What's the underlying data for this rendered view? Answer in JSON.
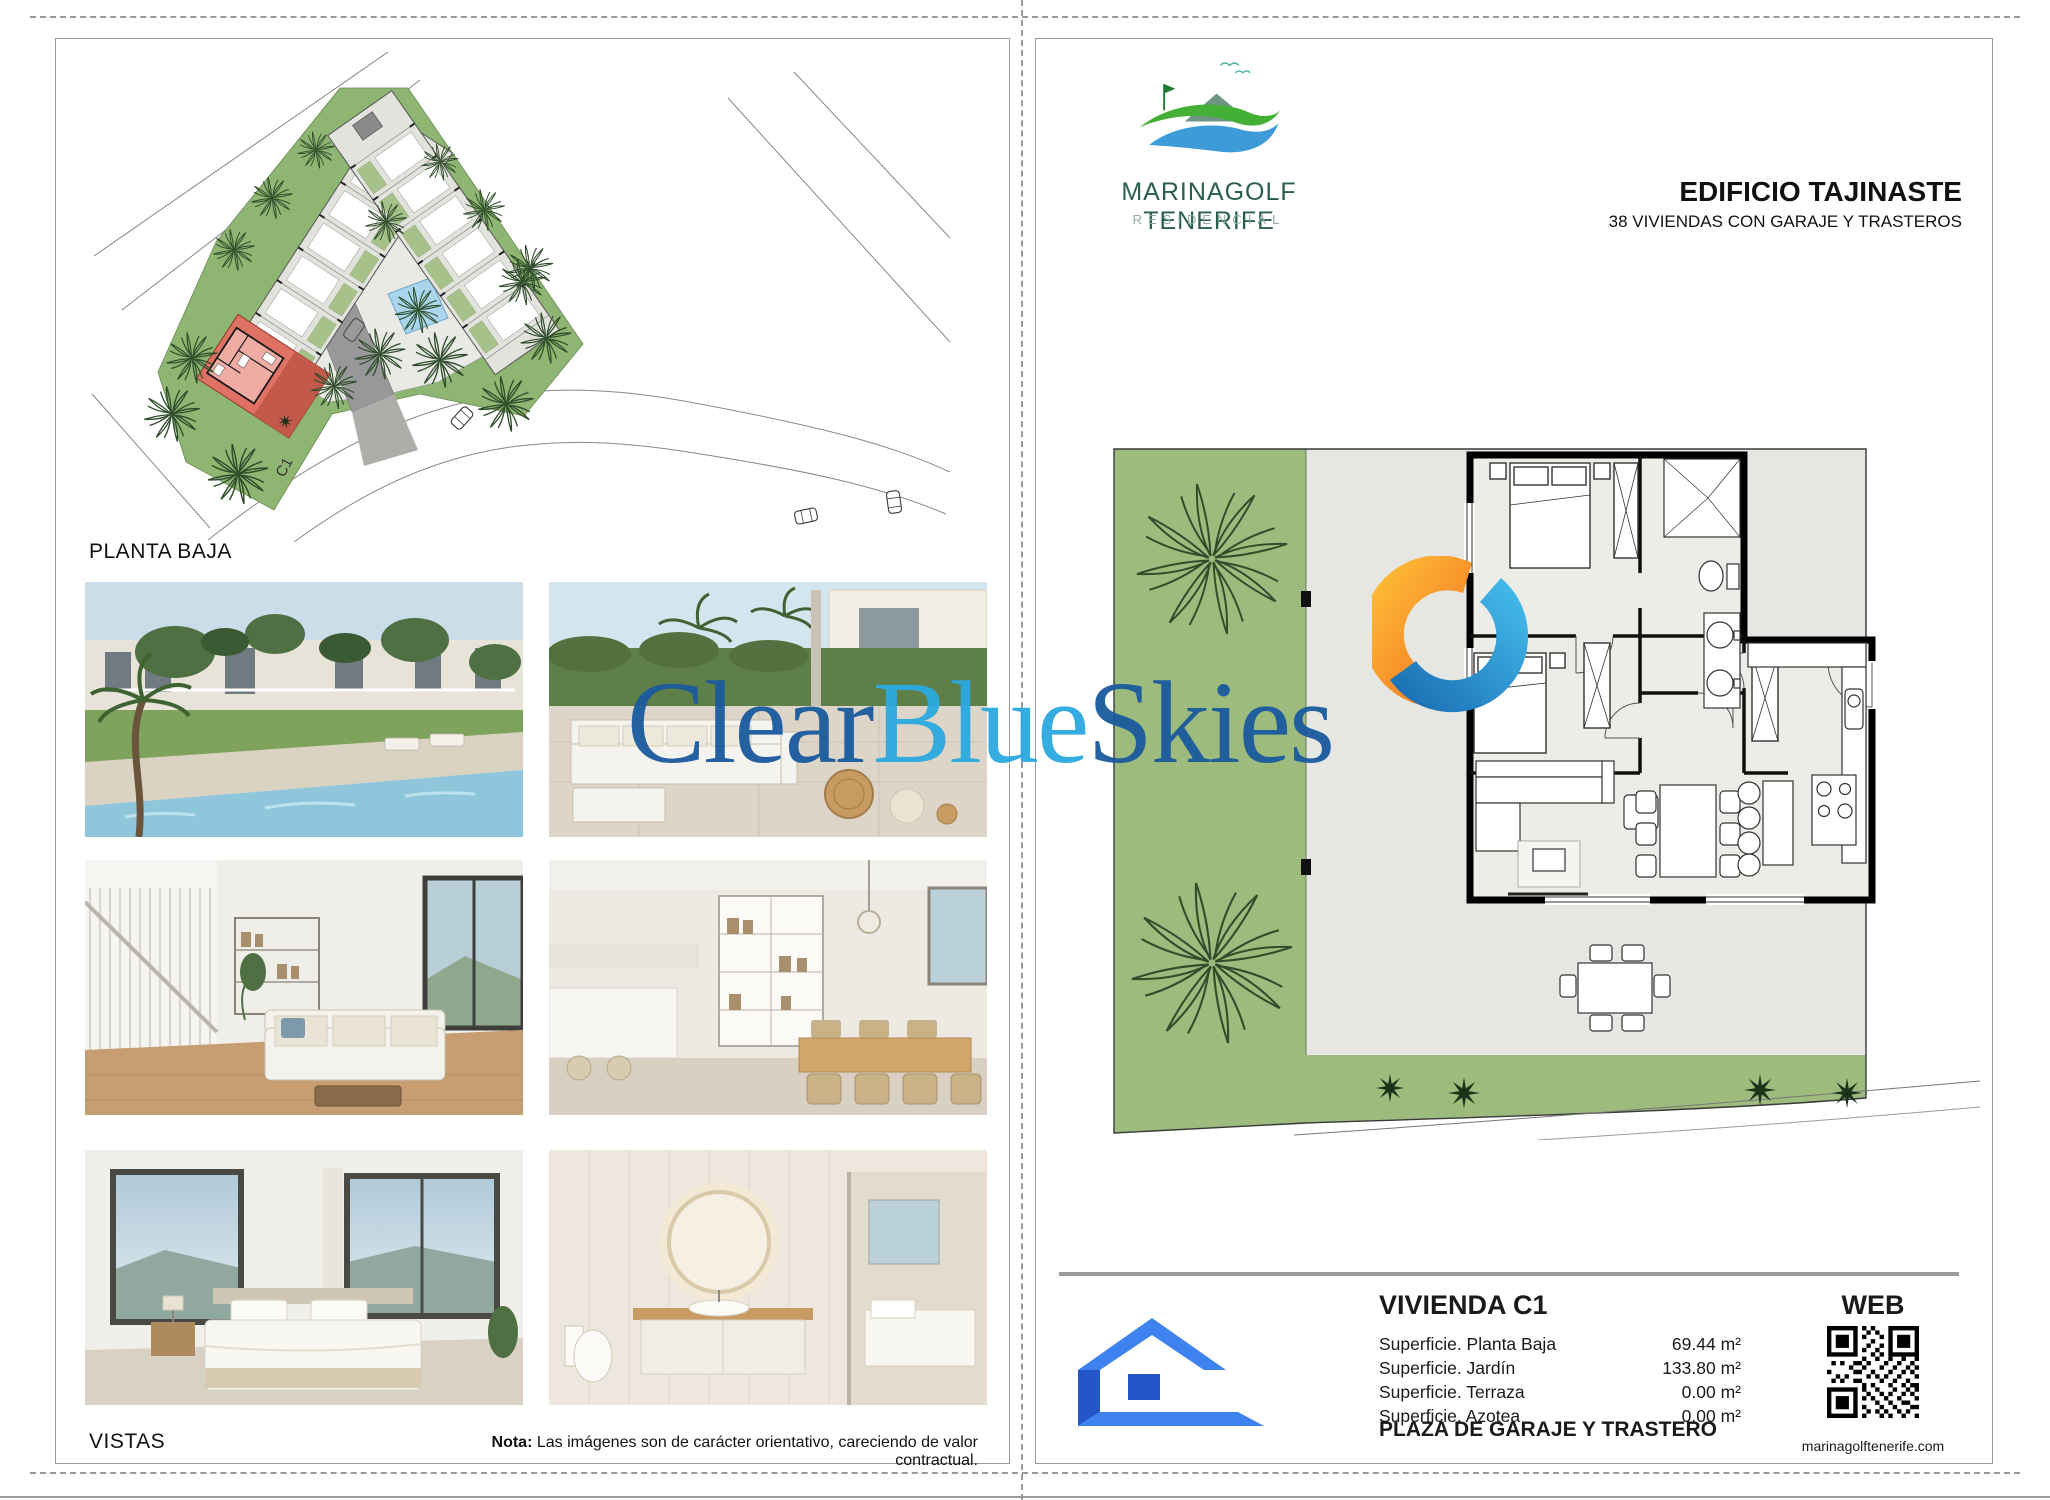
{
  "brand": {
    "name": "MARINAGOLF TENERIFE",
    "tagline": "RESIDENCIAL"
  },
  "header": {
    "title": "EDIFICIO TAJINASTE",
    "subtitle": "38 VIVIENDAS CON GARAJE Y TRASTEROS"
  },
  "left_page": {
    "plan_label": "PLANTA BAJA",
    "unit_marker": "C1",
    "photos_label": "VISTAS",
    "note": {
      "bold": "Nota:",
      "text": " Las imágenes son de carácter orientativo, careciendo de valor contractual."
    }
  },
  "unit_card": {
    "title": "VIVIENDA C1",
    "surfaces": [
      {
        "label": "Superficie. Planta Baja",
        "value": "69.44",
        "unit": "m²"
      },
      {
        "label": "Superficie. Jardín",
        "value": "133.80",
        "unit": "m²"
      },
      {
        "label": "Superficie. Terraza",
        "value": "0.00",
        "unit": "m²"
      },
      {
        "label": "Superficie. Azotea",
        "value": "0.00",
        "unit": "m²"
      }
    ],
    "footer": "PLAZA DE GARAJE Y TRASTERO"
  },
  "web": {
    "label": "WEB",
    "url": "marinagolftenerife.com"
  },
  "watermark": {
    "clear": "Clear",
    "blue": "Blue",
    "skies": "Skies"
  },
  "colors": {
    "brand_green": "#2A5F4C",
    "brand_light_green": "#8FAE9E",
    "watermark_navy": "#1A5A9E",
    "watermark_blue": "#2BA9E0",
    "highlight_red": "#DF7265",
    "garden_green": "#9CBB7D",
    "site_green": "#8FB573",
    "icon_blue": "#3E82F0",
    "pool_blue": "#A9D6EE"
  }
}
